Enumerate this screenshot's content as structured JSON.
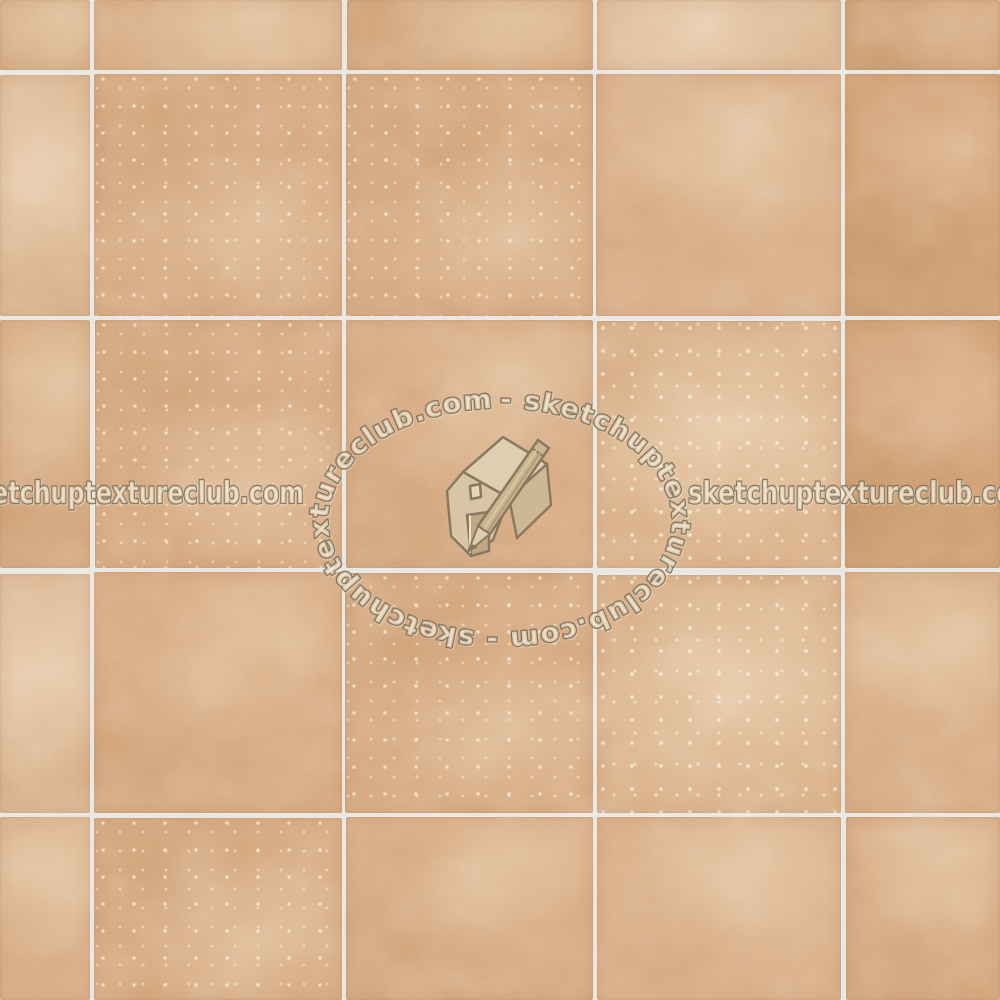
{
  "texture": {
    "description": "terracotta cotto square floor tiles with light grout",
    "grout_color": "#e7e5e0",
    "tile_base_color": "#d5a67b",
    "tile_light_color": "#e6c9a4",
    "tile_dark_color": "#c9935f",
    "grid": {
      "columns": 5,
      "rows": 5,
      "col_edges": [
        0,
        92,
        344,
        595,
        843,
        1000
      ],
      "row_edges": [
        0,
        72,
        318,
        570,
        815,
        1000
      ],
      "gap": 4
    },
    "variant_map": [
      [
        0,
        5,
        0,
        1,
        2
      ],
      [
        1,
        4,
        4,
        5,
        2
      ],
      [
        0,
        4,
        0,
        3,
        2
      ],
      [
        1,
        0,
        4,
        3,
        5
      ],
      [
        5,
        4,
        0,
        5,
        0
      ]
    ],
    "jitter": [
      [
        [
          0,
          0
        ],
        [
          0,
          0
        ],
        [
          1,
          0
        ],
        [
          0,
          0
        ],
        [
          0,
          0
        ]
      ],
      [
        [
          0,
          1
        ],
        [
          0,
          0
        ],
        [
          0,
          0
        ],
        [
          -1,
          0
        ],
        [
          0,
          0
        ]
      ],
      [
        [
          0,
          0
        ],
        [
          1,
          0
        ],
        [
          0,
          0
        ],
        [
          0,
          1
        ],
        [
          0,
          0
        ]
      ],
      [
        [
          0,
          2
        ],
        [
          0,
          0
        ],
        [
          -1,
          1
        ],
        [
          0,
          3
        ],
        [
          0,
          0
        ]
      ],
      [
        [
          0,
          0
        ],
        [
          0,
          1
        ],
        [
          0,
          0
        ],
        [
          0,
          0
        ],
        [
          1,
          0
        ]
      ]
    ]
  },
  "watermark": {
    "ring_text": "-  sketchuptextureclub.com  -  sketchuptextureclub.com",
    "left_text": "etchuptextureclub.com",
    "right_text": "sketchuptextureclub.co",
    "logo_name": "sketchup-house-pencil",
    "text_fill": "#f5e8d0",
    "text_stroke": "#786852",
    "logo_outline": "#84745e",
    "logo_fill_light": "#e0d2b5",
    "logo_fill_mid": "#c9b691",
    "logo_fill_dark": "#bfa884"
  }
}
